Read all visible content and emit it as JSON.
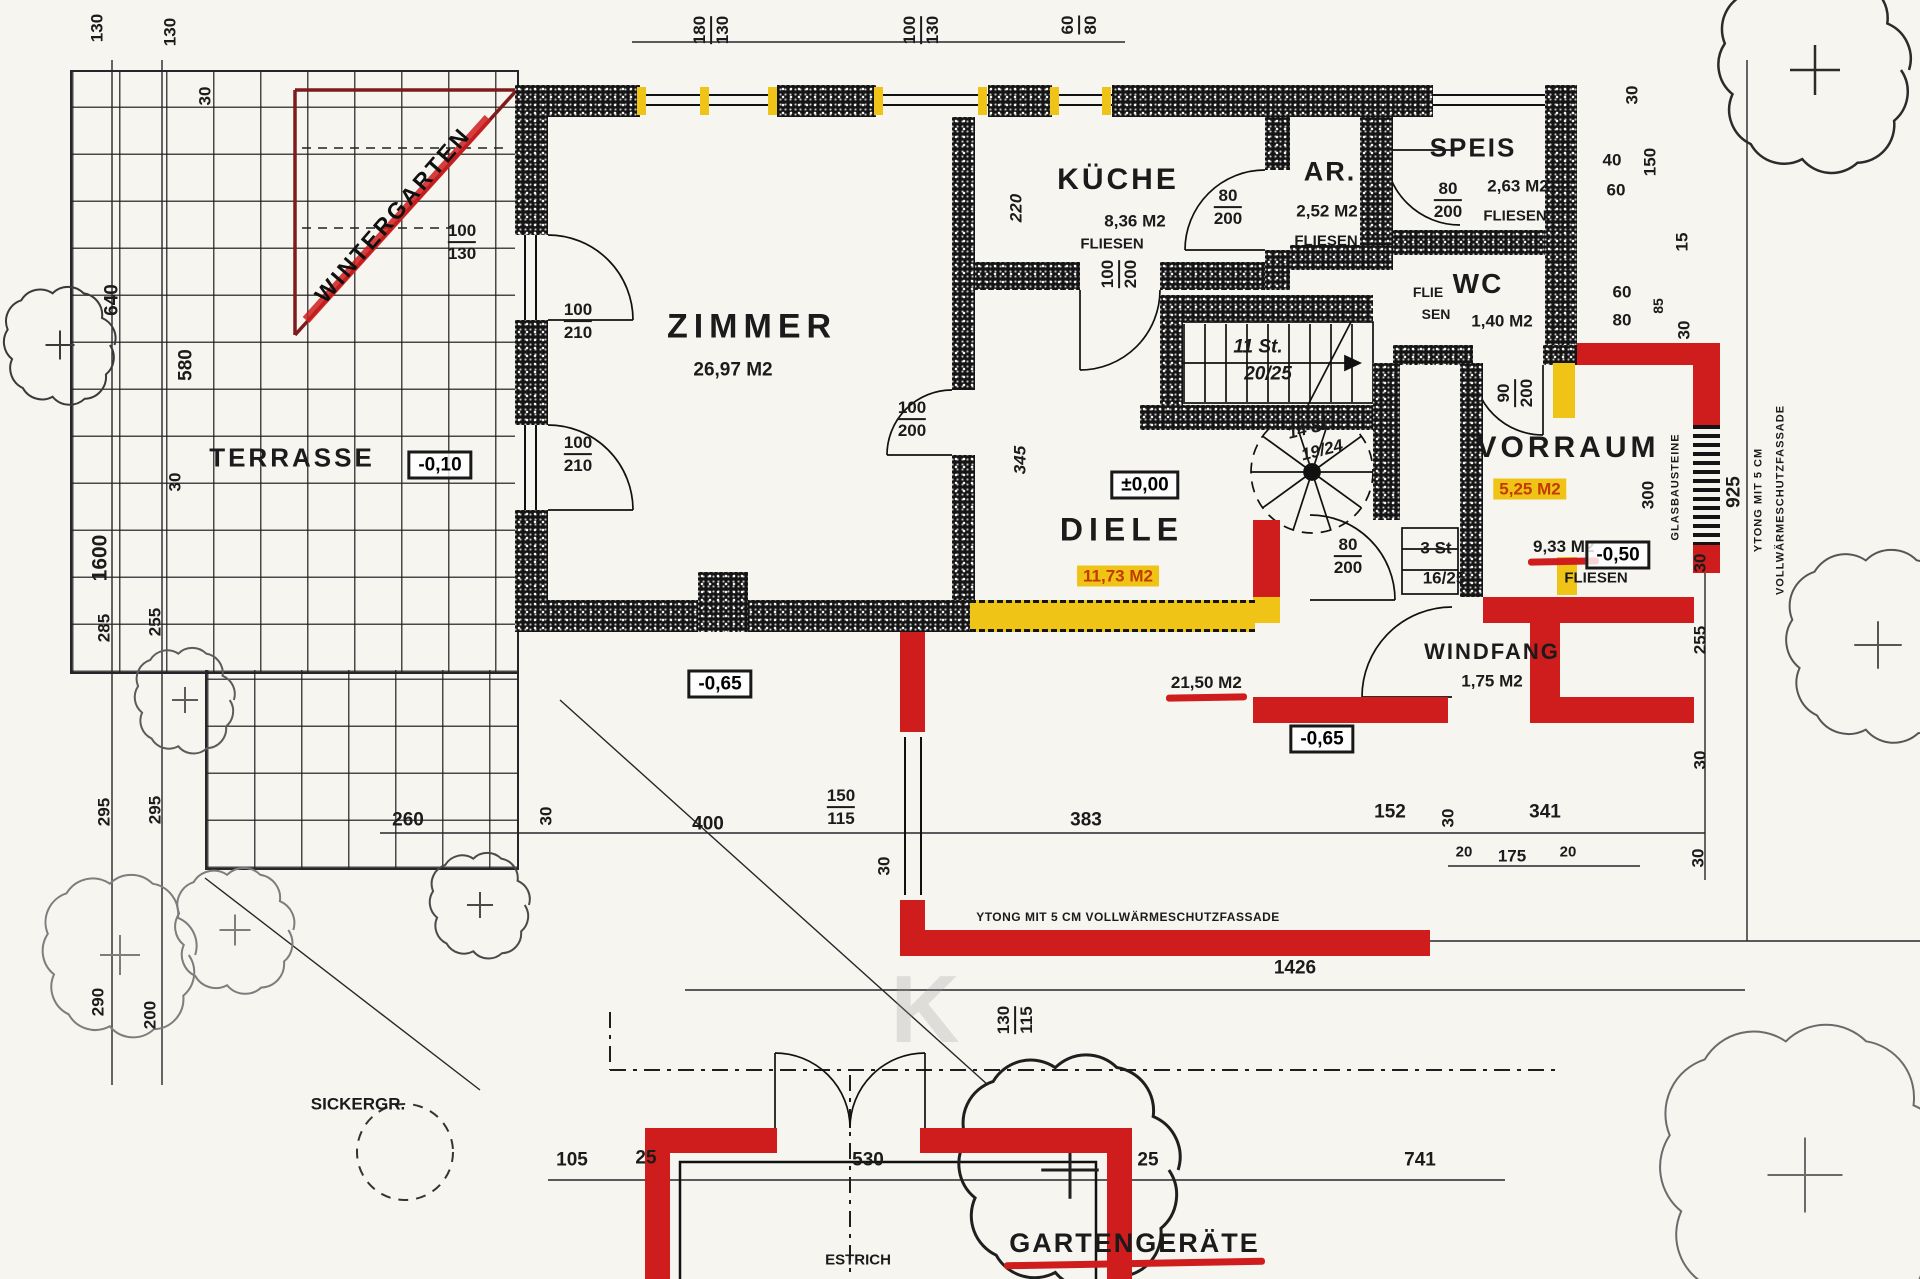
{
  "colors": {
    "red": "#cf1d1d",
    "yellow": "#f0c417",
    "wall": "#151515",
    "paper": "#f6f5f0"
  },
  "plan": {
    "rooms": {
      "zimmer": {
        "name": "ZIMMER",
        "area": "26,97 M2"
      },
      "kueche": {
        "name": "KÜCHE",
        "area": "8,36 M2",
        "floor": "FLIESEN"
      },
      "ar": {
        "name": "AR.",
        "area": "2,52 M2",
        "floor": "FLIESEN"
      },
      "speis": {
        "name": "SPEIS",
        "area": "2,63 M2",
        "floor": "FLIESEN"
      },
      "wc": {
        "name": "WC",
        "floor_a": "FLIE",
        "floor_b": "SEN",
        "area": "1,40 M2"
      },
      "vorraum": {
        "name": "VORRAUM",
        "area_old": "5,25 M2",
        "area_new": "9,33 M2",
        "floor": "FLIESEN"
      },
      "diele": {
        "name": "DIELE",
        "area_old": "11,73 M2",
        "area_new": "21,50 M2"
      },
      "windfang": {
        "name": "WINDFANG",
        "area": "1,75 M2"
      },
      "terrasse": {
        "name": "TERRASSE"
      },
      "wintergarten": {
        "name": "WINTERGARTEN"
      },
      "gartengeraete": {
        "name": "GARTENGERÄTE",
        "floor": "ESTRICH",
        "area": "10,60 M2"
      },
      "sickergrube": {
        "name": "SICKERGR."
      }
    },
    "levels": {
      "diele": "±0,00",
      "terrasse": "-0,10",
      "vorraum": "-0,50",
      "outside_west": "-0,65",
      "outside_east": "-0,65"
    },
    "stairs": {
      "main_count": "11 St.",
      "main_step": "20/25",
      "spiral_count": "14 St.",
      "spiral_step": "19/24",
      "entry_count": "3 St",
      "entry_step": "16/25"
    },
    "notes": {
      "facade_bottom": "YTONG MIT 5 CM VOLLWÄRMESCHUTZFASSADE",
      "facade_right_1": "YTONG MIT 5 CM",
      "facade_right_2": "VOLLWÄRMESCHUTZFASSADE",
      "glass_blocks": "GLASBAUSTEINE"
    },
    "watermark": "K",
    "dims": {
      "top_130a": "130",
      "top_130b": "130",
      "top_30": "30",
      "win_zimmer_top": {
        "a": "180",
        "b": "130"
      },
      "win_kueche_top": {
        "a": "100",
        "b": "130"
      },
      "win_ar_top": {
        "a": "60",
        "b": "80"
      },
      "wg_win": {
        "a": "100",
        "b": "130"
      },
      "door_z1": {
        "a": "100",
        "b": "210"
      },
      "door_z2": {
        "a": "100",
        "b": "210"
      },
      "door_zd": {
        "a": "100",
        "b": "200"
      },
      "door_k1": {
        "a": "80",
        "b": "200"
      },
      "door_k2": {
        "a": "100",
        "b": "200"
      },
      "door_speis": {
        "a": "80",
        "b": "200"
      },
      "door_wc": {
        "a": "90",
        "b": "200"
      },
      "door_wf": {
        "a": "80",
        "b": "200"
      },
      "dim_220": "220",
      "dim_345": "345",
      "right_30a": "30",
      "right_40": "40",
      "right_150": "150",
      "right_60a": "60",
      "right_15": "15",
      "right_60b": "60",
      "right_80": "80",
      "right_85": "85",
      "right_30b": "30",
      "right_300": "300",
      "right_925": "925",
      "right_30c": "30",
      "right_255": "255",
      "right_30d": "30",
      "left_640": "640",
      "left_580": "580",
      "left_1600": "1600",
      "left_30": "30",
      "left_285": "285",
      "left_255": "255",
      "left_295a": "295",
      "left_295b": "295",
      "left_290": "290",
      "left_200": "200",
      "bot_260": "260",
      "bot_30a": "30",
      "bot_400": "400",
      "bot_150": "150",
      "bot_115": "115",
      "bot_30b": "30",
      "bot_383": "383",
      "bot_152": "152",
      "bot_30c": "30",
      "bot_341": "341",
      "bot_20a": "20",
      "bot_175": "175",
      "bot_20b": "20",
      "bot_30d": "30",
      "bot_1426": "1426",
      "win_sud": {
        "a": "130",
        "b": "115"
      },
      "bot_105": "105",
      "bot_25a": "25",
      "bot_530": "530",
      "bot_25b": "25",
      "bot_741": "741"
    }
  }
}
